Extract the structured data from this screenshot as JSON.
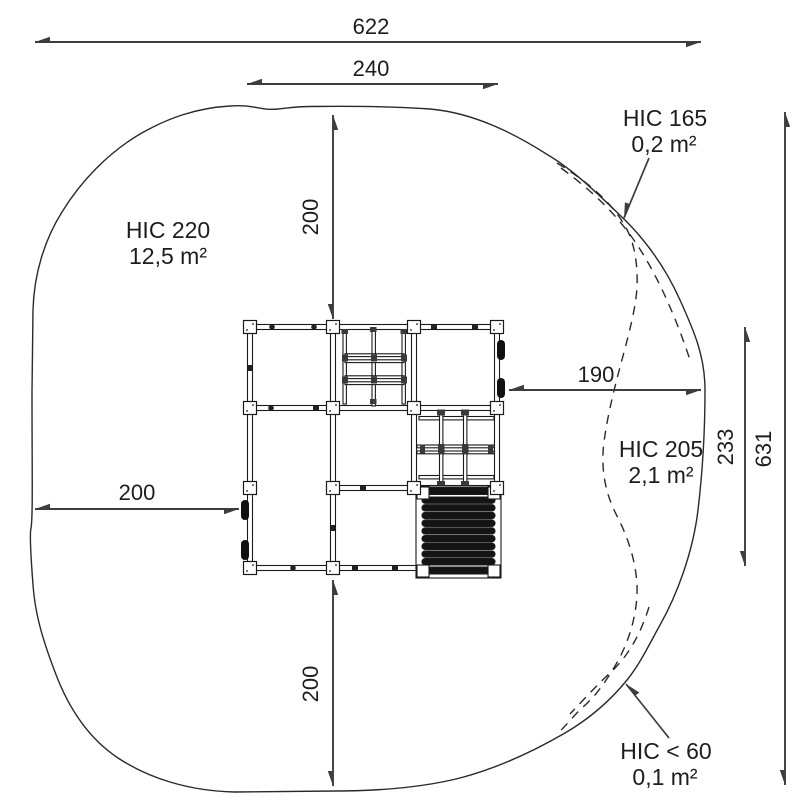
{
  "dimensions": {
    "overall_width": "622",
    "inner_width": "240",
    "top_offset": "200",
    "right_offset": "190",
    "left_offset": "200",
    "bottom_offset": "200",
    "structure_depth": "233",
    "overall_depth": "631"
  },
  "hic_zones": {
    "hic220": {
      "label": "HIC 220",
      "area": "12,5 m²"
    },
    "hic165": {
      "label": "HIC 165",
      "area": "0,2 m²"
    },
    "hic205": {
      "label": "HIC 205",
      "area": "2,1 m²"
    },
    "hic_lt_60": {
      "label": "HIC < 60",
      "area": "0,1 m²"
    }
  },
  "colors": {
    "outline": "#2b2a29",
    "structure": "#1a1a1a",
    "dimension": "#3d3d3c",
    "text": "#1d1d1b",
    "roller": "#141414",
    "background": "#ffffff"
  }
}
